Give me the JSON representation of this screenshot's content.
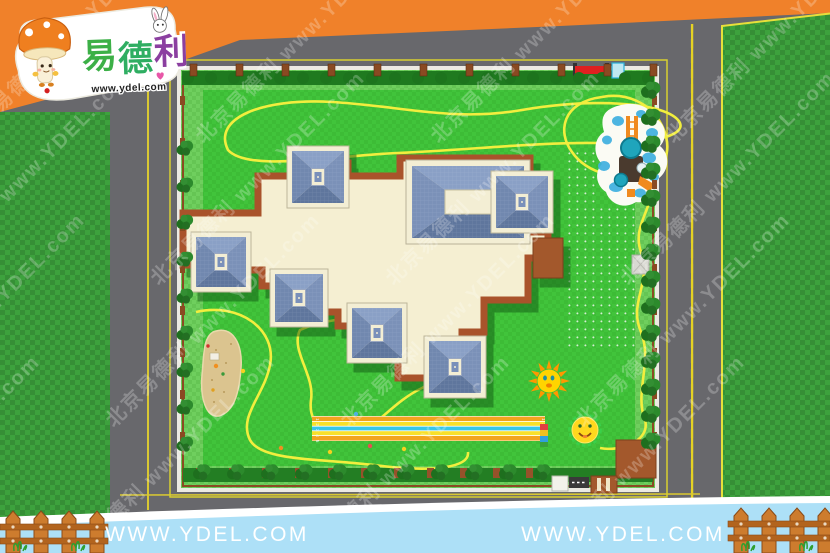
{
  "logo": {
    "brand": "易德利",
    "brand_chars": [
      "易",
      "德",
      "利"
    ],
    "url": "www.ydel.com",
    "mascot_icon": "mushroom-mascot-icon",
    "rabbit_icon": "rabbit-icon",
    "heart_icon": "heart-icon"
  },
  "watermark": {
    "text_cn": "北京易德利",
    "text_url": "www.YDEL.com"
  },
  "footer": {
    "url_left": "WWW.YDEL.COM",
    "url_right": "WWW.YDEL.COM"
  },
  "playground": {
    "lane_numbers_display": "1 2 3 4 5",
    "sun_icon": "sun-icon",
    "smiley_icon": "smiley-flower-icon"
  },
  "colors": {
    "banner_orange": "#f0812a",
    "road_gray": "#68686c",
    "outer_grass_green": "#3da23d",
    "lawn_green": "#41c43b",
    "lawn_border_green": "#6fcf5e",
    "hedge_green": "#1f7a1f",
    "path_yellow": "#f2ee3e",
    "roof_blue": "#7a90ba",
    "roof_cream": "#f3eed4",
    "building_brown": "#a9532b",
    "pad_brown": "#a3582c",
    "sand_tan": "#dbc48f",
    "track_orange": "#f2a41d",
    "track_yellow": "#f8e02a",
    "track_cyan": "#38c6e8",
    "sun_yellow": "#ffd400",
    "ray_orange": "#ff9800",
    "pad_blue": "#3fb0e0",
    "footer_blue": "#ade0f7",
    "fence_wood": "#cd7c2e",
    "white": "#ffffff"
  }
}
